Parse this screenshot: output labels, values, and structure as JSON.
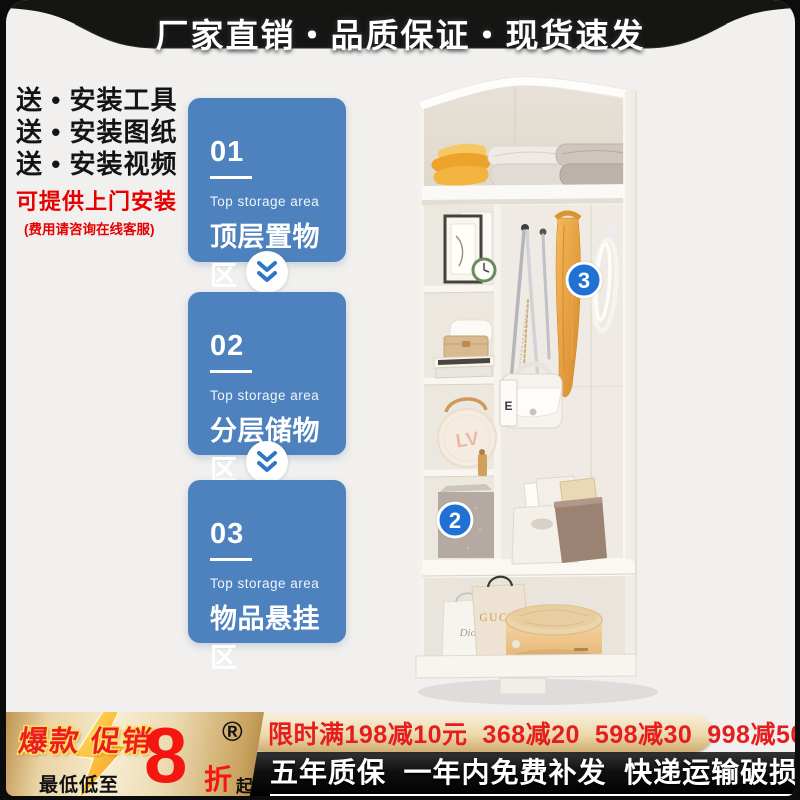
{
  "header": {
    "title": "厂家直销・品质保证・现货速发"
  },
  "left_info": {
    "gift_lines": [
      "送 • 安装工具",
      "送 • 安装图纸",
      "送 • 安装视频"
    ],
    "install_offer": "可提供上门安装",
    "install_note": "(费用请咨询在线客服)"
  },
  "features": [
    {
      "num": "01",
      "en": "Top storage area",
      "zh": "顶层置物区"
    },
    {
      "num": "02",
      "en": "Top storage area",
      "zh": "分层储物区"
    },
    {
      "num": "03",
      "en": "Top storage area",
      "zh": "物品悬挂区"
    }
  ],
  "product": {
    "marker_2": "2",
    "marker_3": "3",
    "bag_brand_gucci": "GUCCI",
    "bag_brand_dior": "Dior",
    "round_bag_monogram": "LV",
    "handbag_tag": "E"
  },
  "promo": {
    "hot_label": "爆款 促销",
    "lowest_label": "最低低至",
    "discount_digit": "8",
    "discount_unit": "折",
    "discount_from": "起",
    "registered_mark": "®",
    "coupon_text": "限时满198减10元  368减20  598减30  998减50",
    "service_text": "五年质保  一年内免费补发  快递运输破损包赔"
  },
  "colors": {
    "accent_blue": "#4e82bf",
    "marker_blue": "#1f71d4",
    "promo_red": "#ed1c24",
    "coupon_red": "#e51d1d",
    "gold": "#e9d4a4",
    "banner_black": "#141414"
  }
}
